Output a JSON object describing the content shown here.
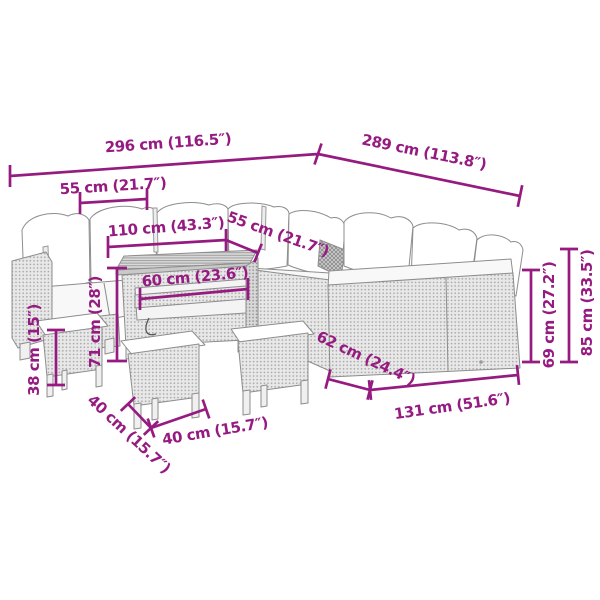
{
  "figure": {
    "kind": "product-dimension-diagram",
    "background": "#ffffff"
  },
  "colors": {
    "dimension": "#951B81",
    "outline": "#8d8d8d",
    "rattan_fill": "#e8e8e8",
    "cushion_fill": "#ffffff"
  },
  "dims": {
    "d296": "296 cm (116.5″)",
    "d289": "289 cm (113.8″)",
    "d55_left": "55 cm (21.7″)",
    "d110": "110 cm (43.3″)",
    "d55_back": "55 cm (21.7″)",
    "d60": "60 cm (23.6″)",
    "d71": "71 cm (28″)",
    "d38": "38 cm (15″)",
    "d40_side": "40 cm (15.7″)",
    "d40_front": "40 cm (15.7″)",
    "d62": "62 cm (24.4″)",
    "d131": "131 cm (51.6″)",
    "d69": "69 cm (27.2″)",
    "d85": "85 cm (33.5″)"
  }
}
